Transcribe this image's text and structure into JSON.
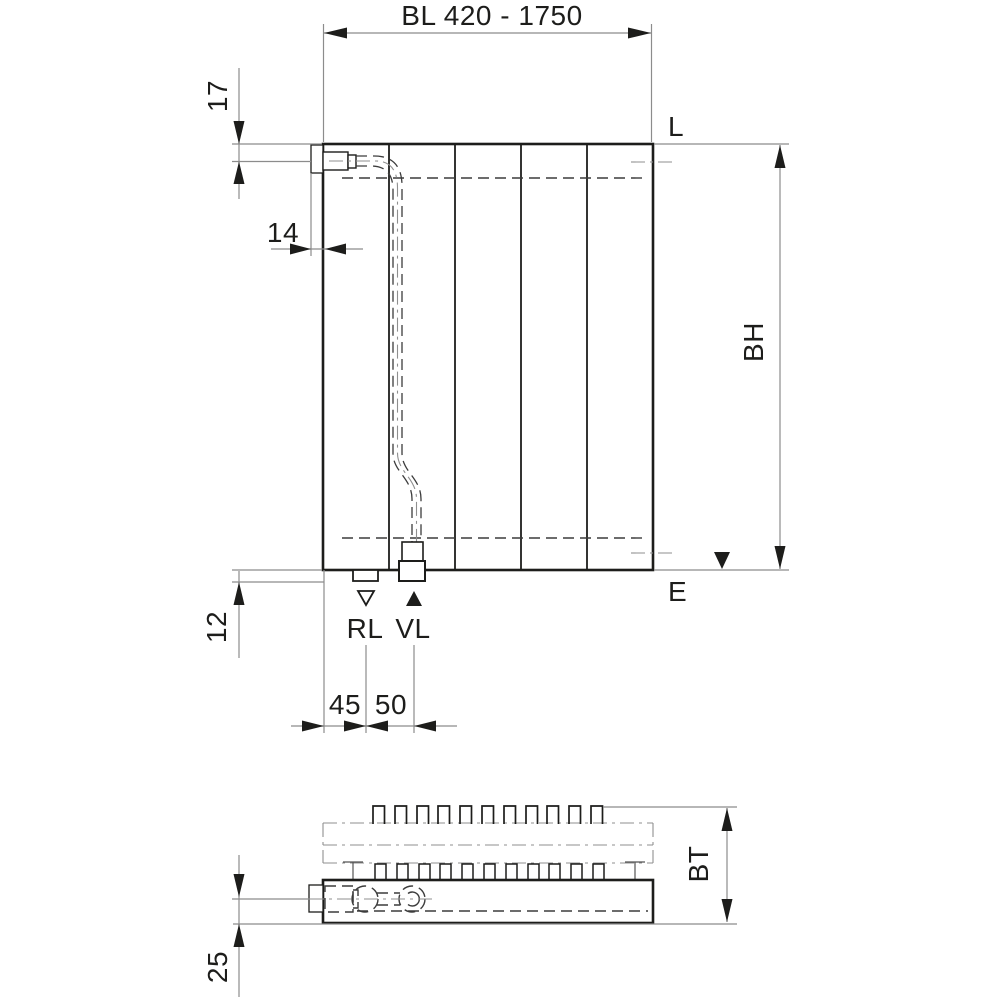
{
  "drawing": {
    "type": "radiator dimensional drawing",
    "views": [
      "front elevation",
      "plan section"
    ],
    "labels": {
      "bl": "BL 420 - 1750",
      "offset_top": "17",
      "offset_side": "14",
      "offset_bottom": "12",
      "rl_spacing": "45",
      "vl_spacing": "50",
      "height": "BH",
      "depth": "BT",
      "wall_clearance": "25",
      "level_top": "L",
      "level_bottom": "E",
      "return_conn": "RL",
      "supply_conn": "VL"
    }
  },
  "colors": {
    "bg": "#ffffff",
    "ink": "#1d1d1b",
    "dim": "#8c8c8c",
    "hidden": "#3c3c3c",
    "center": "#8f8f8f"
  }
}
